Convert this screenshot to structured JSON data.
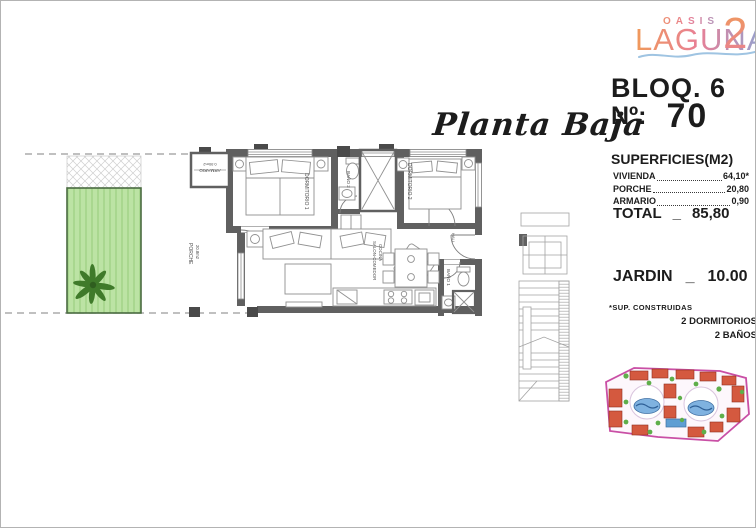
{
  "logo": {
    "top": "OASIS",
    "main": "LAGUNA",
    "suffix": "2"
  },
  "unit": {
    "block": "BLOQ. 6",
    "number_label": "Nº:",
    "number": "70"
  },
  "plan_title": "Planta Baja",
  "surfaces": {
    "title": "SUPERFICIES(M2)",
    "rows": [
      {
        "label": "VIVIENDA",
        "value": "64,10*"
      },
      {
        "label": "PORCHE",
        "value": "20,80"
      },
      {
        "label": "ARMARIO",
        "value": "0,90"
      }
    ],
    "total": {
      "label": "TOTAL",
      "sep": "_",
      "value": "85,80"
    },
    "garden": {
      "label": "JARDIN",
      "sep": "_",
      "value": "10.00"
    },
    "footnote": "*SUP. CONSTRUIDAS",
    "features": [
      "2 DORMITORIOS",
      "2 BAÑOS"
    ]
  },
  "rooms": {
    "armario": {
      "name": "ARMARIO",
      "area": "0.90m2"
    },
    "dormitorio1": {
      "name": "DORMITORIO 1"
    },
    "bano2": {
      "name": "BAÑO 2"
    },
    "dormitorio2": {
      "name": "DORMITORIO 2"
    },
    "salon": {
      "name": "SALON-COMEDOR",
      "name2": "COCINA"
    },
    "hall": {
      "name": "HALL"
    },
    "bano1": {
      "name": "BAÑO 1"
    },
    "porche": {
      "name": "PORCHE",
      "area": "20.8m2"
    }
  },
  "colors": {
    "logo_gradient_start": "#f09a5a",
    "logo_gradient_mid": "#e87f96",
    "logo_gradient_end": "#8ba6d6",
    "wall_gray": "#606060",
    "garden_green": "#bce3a4",
    "palm_green": "#3f7a2a",
    "siteplan_magenta": "#c94fa5"
  }
}
